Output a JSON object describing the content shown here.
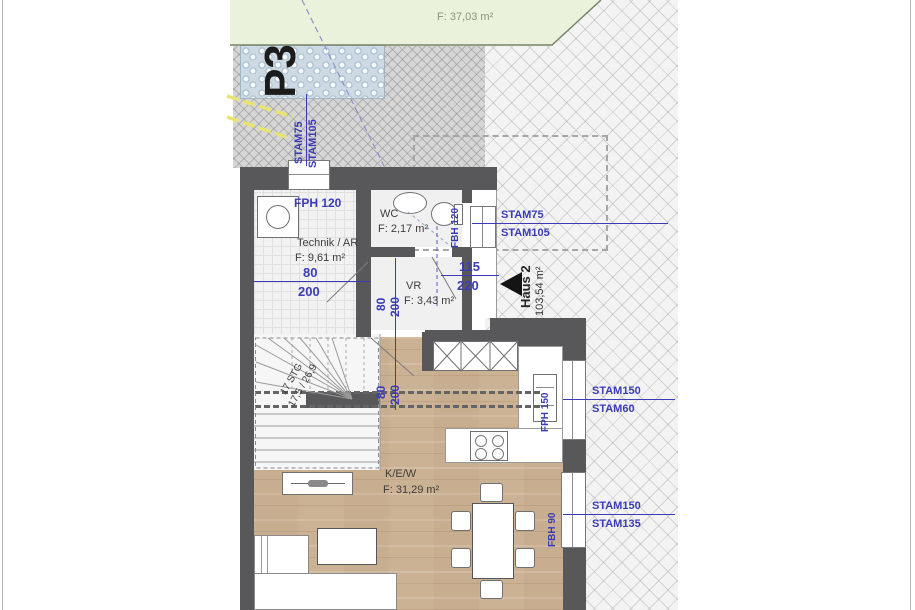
{
  "site": {
    "garden": {
      "label": "Gartenfläche Haus 2",
      "area": "F: 37,03 m²"
    },
    "parking": {
      "label": "P3"
    },
    "house": {
      "label": "Haus 2",
      "area": "103,54 m²"
    }
  },
  "rooms": {
    "technik": {
      "name": "Technik / AR",
      "area": "F: 9,61 m²"
    },
    "wc": {
      "name": "WC",
      "area": "F: 2,17 m²"
    },
    "vr": {
      "name": "VR",
      "area": "F: 3,43 m²"
    },
    "kew": {
      "name": "K/E/W",
      "area": "F: 31,29 m²"
    }
  },
  "stairs": {
    "count": "17 STG",
    "dims": "17,5 / 26,9"
  },
  "openings": {
    "top_window": {
      "stam1": "STAM75",
      "stam2": "STAM105",
      "sill": "FPH 120"
    },
    "entry": {
      "stam1": "STAM75",
      "stam2": "STAM105",
      "sill": "FBH 120",
      "width": "115",
      "height": "220"
    },
    "east_window_upper": {
      "stam1": "STAM150",
      "stam2": "STAM60",
      "sill": "FPH 150"
    },
    "east_window_lower": {
      "stam1": "STAM150",
      "stam2": "STAM135",
      "sill": "FBH 90"
    },
    "technik_door": {
      "width": "80",
      "height": "200"
    },
    "vr_door": {
      "width": "80",
      "height": "200"
    },
    "kitchen_door": {
      "width": "80",
      "height": "200"
    }
  },
  "colors": {
    "annotation_blue": "#3b3cb4",
    "wall_grey": "#58585a",
    "wood_floor": "#ccb294",
    "garden_green": "#eaf2dc",
    "gravel_blue": "#cdd9e3"
  }
}
